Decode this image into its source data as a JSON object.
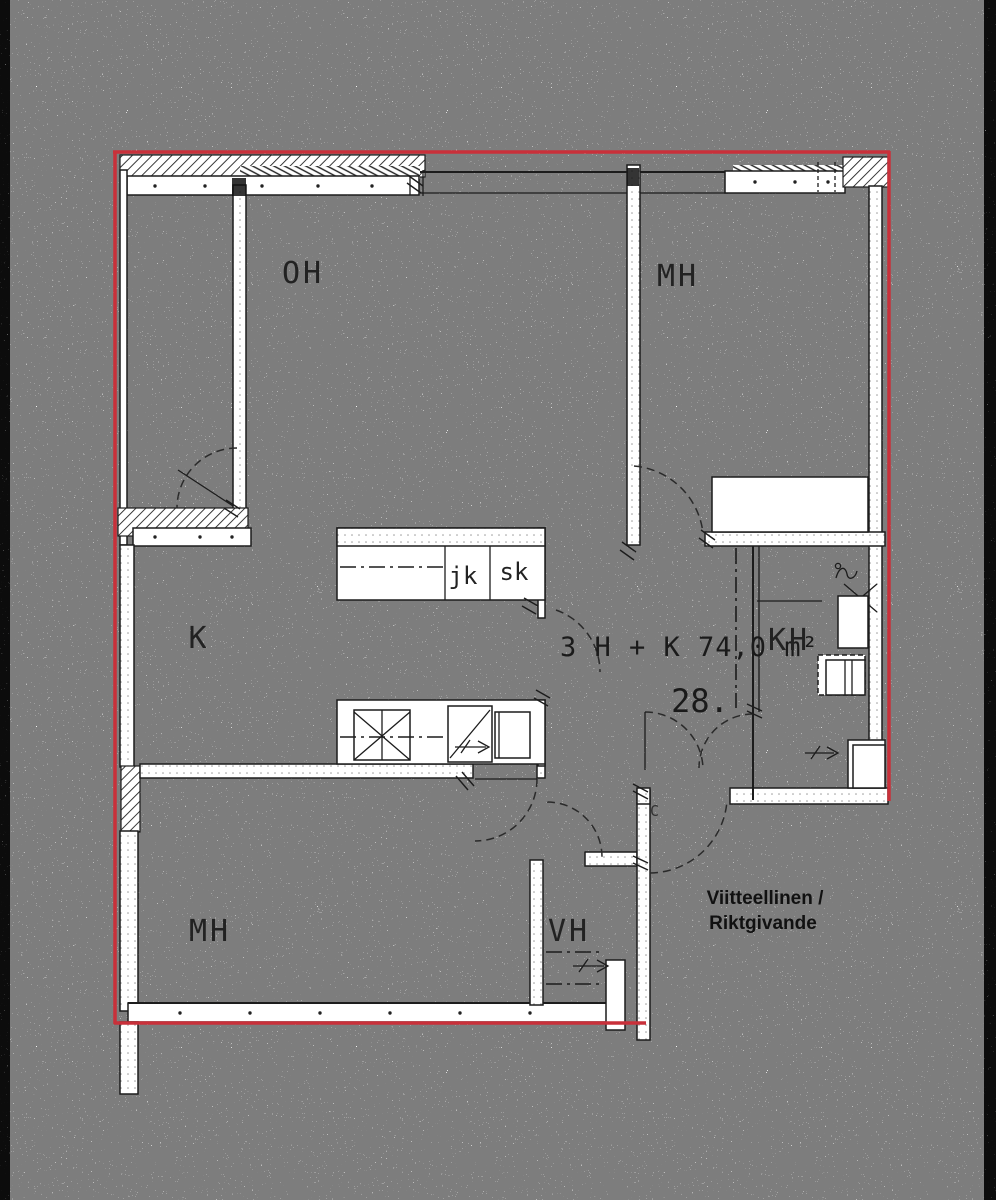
{
  "plan": {
    "rooms": {
      "living": "OH",
      "bedroom_top": "MH",
      "kitchen": "K",
      "bathroom": "KH",
      "hall_closet": "VH",
      "bedroom_bottom": "MH"
    },
    "kitchen_fixtures": {
      "fridge": "jk",
      "cupboard": "sk"
    },
    "apartment": {
      "type_and_area": "3 H + K  74,0 m²",
      "number": "28."
    },
    "entry_label": "C",
    "note": {
      "line1": "Viitteellinen /",
      "line2": "Riktgivande"
    },
    "colors": {
      "boundary_red": "#c9303a",
      "line_black": "#1c1c1c",
      "paper_white": "#fdfdfc"
    }
  }
}
